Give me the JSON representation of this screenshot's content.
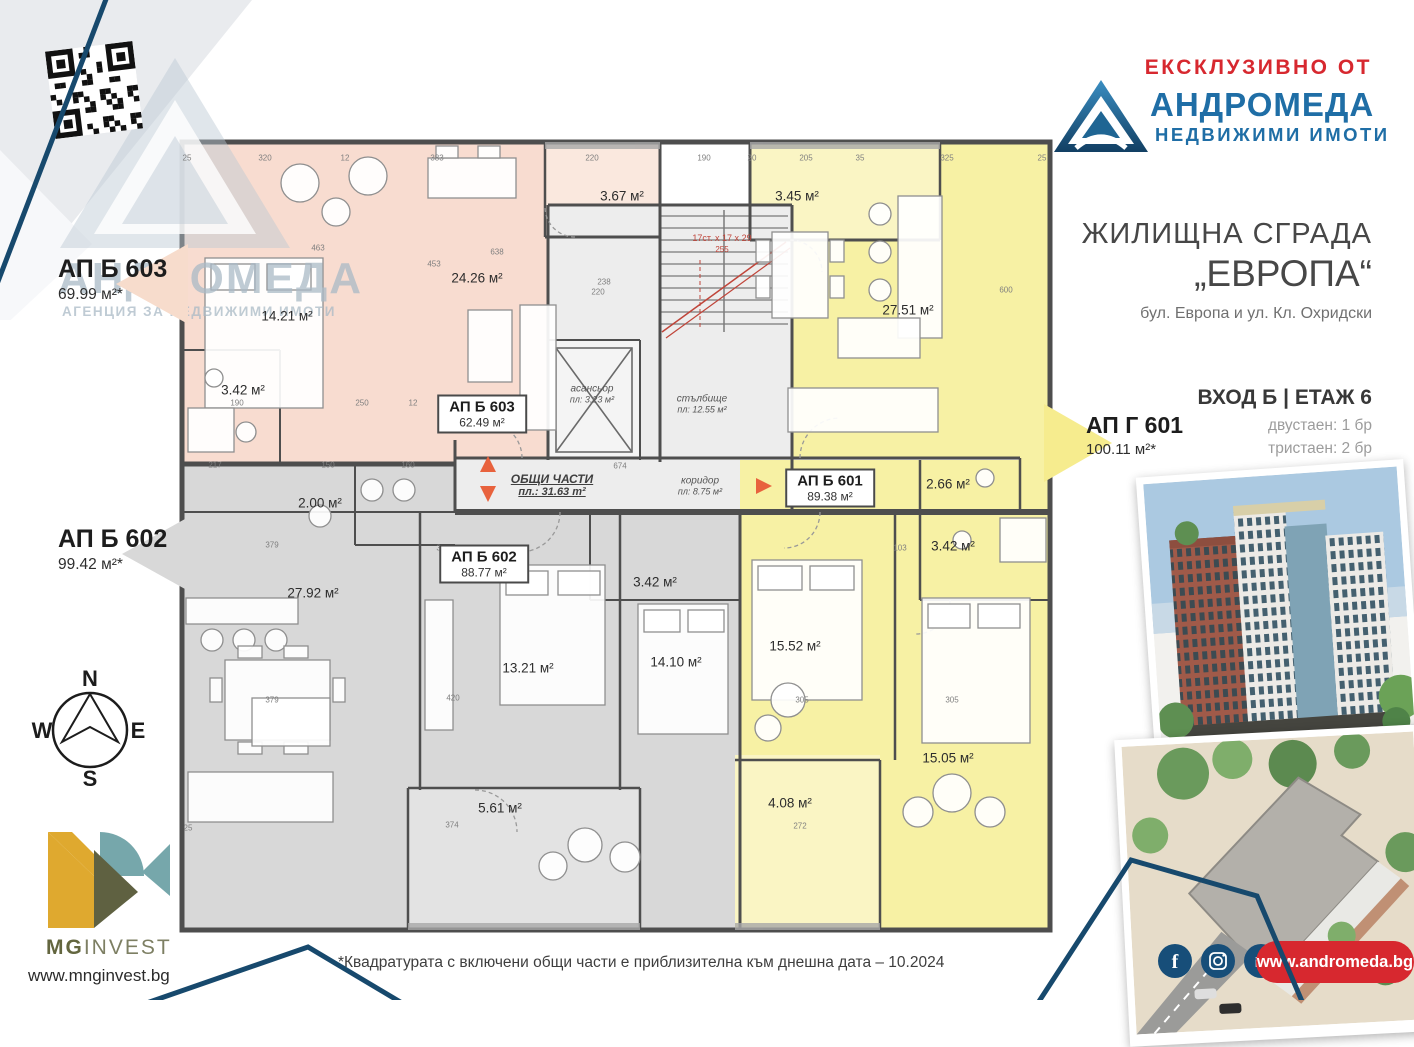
{
  "branding": {
    "exclusive_label": "ЕКСКЛУЗИВНО ОТ",
    "agency_name": "АНДРОМЕДА",
    "agency_tagline": "НЕДВИЖИМИ ИМОТИ",
    "watermark_name": "АНДРОМЕДА",
    "watermark_tagline": "АГЕНЦИЯ ЗА НЕДВИЖИМИ ИМОТИ",
    "agency_website": "www.andromeda.bg",
    "accent_red": "#d7282f",
    "brand_blue": "#1f6ea6",
    "navy": "#17496d"
  },
  "project": {
    "building_title": "ЖИЛИЩНА СГРАДА",
    "building_name": "„ЕВРОПА“",
    "address": "бул. Европа и ул. Кл. Охридски",
    "entrance_floor": "ВХОД Б | ЕТАЖ 6",
    "unit_mix": [
      "двустаен: 1 бр",
      "тристаен: 2 бр"
    ],
    "disclaimer": "*Квадратурата с включени общи части е приблизителна към днешна дата – 10.2024"
  },
  "callouts": [
    {
      "id": "АП Б 603",
      "area": "69.99 м²*",
      "color": "#f7dccc"
    },
    {
      "id": "АП Б 602",
      "area": "99.42 м²*",
      "color": "#d8d8d8"
    },
    {
      "id": "АП Г 601",
      "area": "100.11 м²*",
      "color": "#f6ec8e"
    }
  ],
  "developer": {
    "name_bold": "MG",
    "name_light": "INVEST",
    "website": "www.mnginvest.bg"
  },
  "compass": {
    "n": "N",
    "e": "E",
    "s": "S",
    "w": "W"
  },
  "icons": [
    "facebook",
    "instagram",
    "linkedin"
  ],
  "floor_plan": {
    "colors": {
      "apt_603": "#f8dcd0",
      "apt_603_balcony": "#fae8de",
      "apt_601": "#f7f1a4",
      "apt_601_balcony": "#faf5c4",
      "apt_602": "#d8d8d8",
      "apt_602_balcony": "#e3e3e3",
      "common": "#ededed",
      "wall": "#4e4e4e",
      "arrow_orange": "#e8623d",
      "stair_note_red": "#c0453a"
    },
    "apartment_boxes": [
      {
        "id": "АП Б 603",
        "area": "62.49 м²",
        "x": 482,
        "y": 414
      },
      {
        "id": "АП Б 602",
        "area": "88.77 м²",
        "x": 484,
        "y": 564
      },
      {
        "id": "АП Б 601",
        "area": "89.38 м²",
        "x": 830,
        "y": 488
      }
    ],
    "room_labels": [
      {
        "t": "3.67 м²",
        "x": 622,
        "y": 196
      },
      {
        "t": "3.45 м²",
        "x": 797,
        "y": 196
      },
      {
        "t": "14.21 м²",
        "x": 287,
        "y": 316
      },
      {
        "t": "24.26 м²",
        "x": 477,
        "y": 278
      },
      {
        "t": "3.42 м²",
        "x": 243,
        "y": 390
      },
      {
        "t": "27.51 м²",
        "x": 908,
        "y": 310
      },
      {
        "t": "2.66 м²",
        "x": 948,
        "y": 484
      },
      {
        "t": "3.42 м²",
        "x": 953,
        "y": 546
      },
      {
        "t": "15.52 м²",
        "x": 795,
        "y": 646
      },
      {
        "t": "15.05 м²",
        "x": 948,
        "y": 758
      },
      {
        "t": "4.08 м²",
        "x": 790,
        "y": 803
      },
      {
        "t": "2.00 м²",
        "x": 320,
        "y": 503
      },
      {
        "t": "27.92 м²",
        "x": 313,
        "y": 593
      },
      {
        "t": "13.21 м²",
        "x": 528,
        "y": 668
      },
      {
        "t": "14.10 м²",
        "x": 676,
        "y": 662
      },
      {
        "t": "3.42 м²",
        "x": 655,
        "y": 582
      },
      {
        "t": "5.61 м²",
        "x": 500,
        "y": 808
      }
    ],
    "common_labels": {
      "common_title": "ОБЩИ ЧАСТИ",
      "common_area": "пл.:  31.63 m²",
      "corridor": "коридор",
      "corridor_area": "пл: 8.75 м²",
      "elevator": "асансьор",
      "elevator_area": "пл: 3.23 м²",
      "stairs": "стълбище",
      "stairs_area": "пл: 12.55 м²",
      "stair_note": "17ст. х 17 х 29",
      "stair_dim": "255"
    },
    "dimensions": [
      {
        "v": "25",
        "x": 187,
        "y": 158
      },
      {
        "v": "320",
        "x": 265,
        "y": 158
      },
      {
        "v": "12",
        "x": 345,
        "y": 158
      },
      {
        "v": "383",
        "x": 437,
        "y": 158
      },
      {
        "v": "220",
        "x": 592,
        "y": 158
      },
      {
        "v": "190",
        "x": 704,
        "y": 158
      },
      {
        "v": "20",
        "x": 752,
        "y": 158
      },
      {
        "v": "205",
        "x": 806,
        "y": 158
      },
      {
        "v": "35",
        "x": 860,
        "y": 158
      },
      {
        "v": "325",
        "x": 947,
        "y": 158
      },
      {
        "v": "25",
        "x": 1042,
        "y": 158
      },
      {
        "v": "463",
        "x": 318,
        "y": 248
      },
      {
        "v": "638",
        "x": 497,
        "y": 252
      },
      {
        "v": "238",
        "x": 604,
        "y": 282
      },
      {
        "v": "453",
        "x": 434,
        "y": 264
      },
      {
        "v": "600",
        "x": 1006,
        "y": 290
      },
      {
        "v": "220",
        "x": 598,
        "y": 292
      },
      {
        "v": "190",
        "x": 237,
        "y": 403
      },
      {
        "v": "250",
        "x": 362,
        "y": 403
      },
      {
        "v": "12",
        "x": 413,
        "y": 403
      },
      {
        "v": "217",
        "x": 215,
        "y": 465
      },
      {
        "v": "150",
        "x": 328,
        "y": 465
      },
      {
        "v": "160",
        "x": 408,
        "y": 465
      },
      {
        "v": "674",
        "x": 620,
        "y": 466
      },
      {
        "v": "379",
        "x": 272,
        "y": 545
      },
      {
        "v": "302",
        "x": 443,
        "y": 548
      },
      {
        "v": "379",
        "x": 272,
        "y": 700
      },
      {
        "v": "420",
        "x": 453,
        "y": 698
      },
      {
        "v": "305",
        "x": 802,
        "y": 700
      },
      {
        "v": "305",
        "x": 952,
        "y": 700
      },
      {
        "v": "103",
        "x": 900,
        "y": 548
      },
      {
        "v": "374",
        "x": 452,
        "y": 825
      },
      {
        "v": "272",
        "x": 800,
        "y": 826
      },
      {
        "v": "25",
        "x": 188,
        "y": 828
      }
    ]
  }
}
